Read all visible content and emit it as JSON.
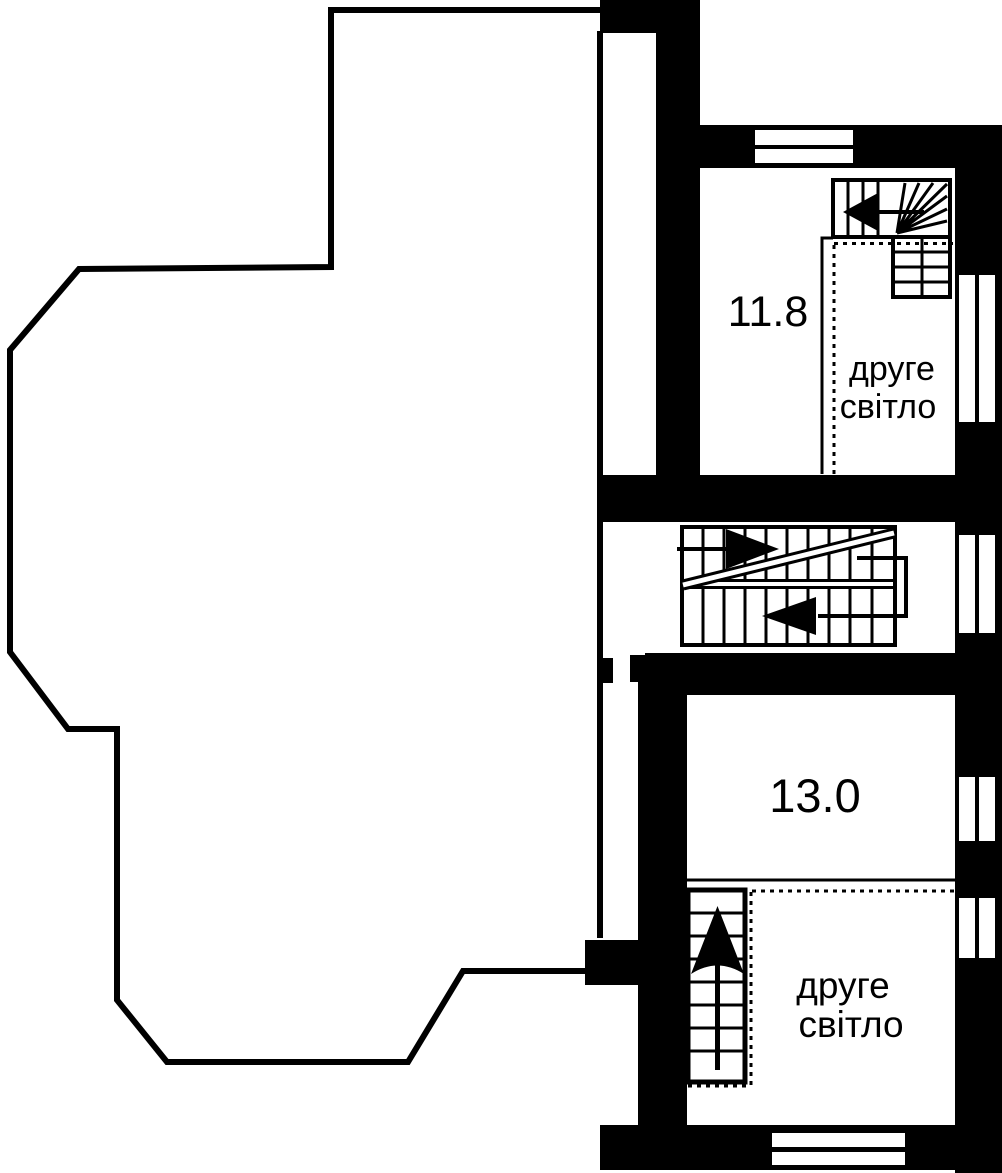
{
  "plan": {
    "colors": {
      "ink": "#000000",
      "paper": "#ffffff"
    },
    "rooms": [
      {
        "name": "upper-right-room",
        "area": "11.8",
        "void_label": {
          "line1": "друге",
          "line2": "світло"
        }
      },
      {
        "name": "lower-right-room",
        "area": "13.0",
        "void_label": {
          "line1": "друге",
          "line2": "світло"
        }
      }
    ]
  }
}
